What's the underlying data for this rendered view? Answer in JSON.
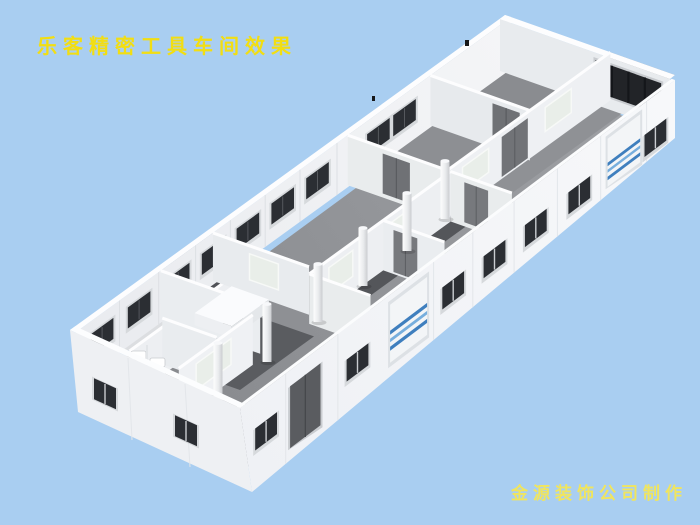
{
  "page": {
    "width": 700,
    "height": 525,
    "background_color": "#A9CEF1"
  },
  "overlay": {
    "title": "乐客精密工具车间效果",
    "title_color": "#F2DE12",
    "credit": "金源装饰公司制作",
    "credit_color": "#F0E55E"
  },
  "scene": {
    "description": "isometric 3D rendering of a long rectangular precision-tool workshop interior: white panel walls, gray concrete floor, dark windows along the perimeter, partitioned rooms at both ends and along the front wall, a row of round support columns in the open hall, two blue-striped roller shutter doors on the front wall and a dark glazing band in the far-right room",
    "colors": {
      "wall_white": "#F2F4F6",
      "wall_top_edge": "#FDFDFE",
      "hall_floor_gray": "#95979B",
      "room_floor_dark": "#55575B",
      "window_dark": "#2B2E33",
      "door_gray": "#74767A",
      "frosted_glass": "#E9EEE9",
      "roller_door_stripe_blue": "#3F7FBE",
      "glazing_band_dark": "#222428",
      "column_white": "#F4F5F7"
    },
    "counts": {
      "support_columns": 6,
      "back_wall_windows": 9,
      "front_wall_windows": 7,
      "roller_shutter_doors": 2,
      "interior_double_doors": 5,
      "frosted_interior_windows": 6
    }
  }
}
